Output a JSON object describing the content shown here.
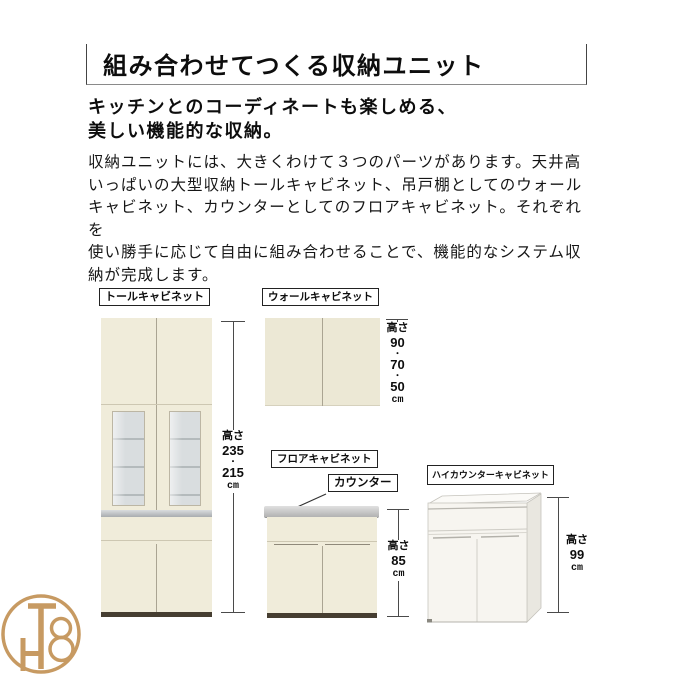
{
  "header": {
    "title": "組み合わせてつくる収納ユニット"
  },
  "intro": {
    "subtitle_line1": "キッチンとのコーディネートも楽しめる、",
    "subtitle_line2": "美しい機能的な収納。",
    "body": "収納ユニットには、大きくわけて３つのパーツがあります。天井高\nいっぱいの大型収納トールキャビネット、吊戸棚としてのウォール\nキャビネット、カウンターとしてのフロアキャビネット。それぞれを\n使い勝手に応じて自由に組み合わせることで、機能的なシステム収\n納が完成します。"
  },
  "cabinets": {
    "tall": {
      "label": "トールキャビネット",
      "dim": {
        "label": "高さ",
        "v1": "235",
        "dot": "・",
        "v2": "215",
        "unit": "cm"
      }
    },
    "wall": {
      "label": "ウォールキャビネット",
      "dim": {
        "label": "高さ",
        "v1": "90",
        "dot1": "・",
        "v2": "70",
        "dot2": "・",
        "v3": "50",
        "unit": "cm"
      }
    },
    "floor": {
      "label": "フロアキャビネット",
      "counter_label": "カウンター",
      "dim": {
        "label": "高さ",
        "v1": "85",
        "unit": "cm"
      }
    },
    "high_counter": {
      "label": "ハイカウンターキャビネット",
      "dim": {
        "label": "高さ",
        "v1": "99",
        "unit": "cm"
      }
    }
  },
  "logo": {
    "monogram": "TH8"
  },
  "colors": {
    "accent_gold": "#c79a62",
    "cabinet_cream": "#f0ecda",
    "counter_silver": "#b5b9bb",
    "base_dark": "#463e31"
  }
}
